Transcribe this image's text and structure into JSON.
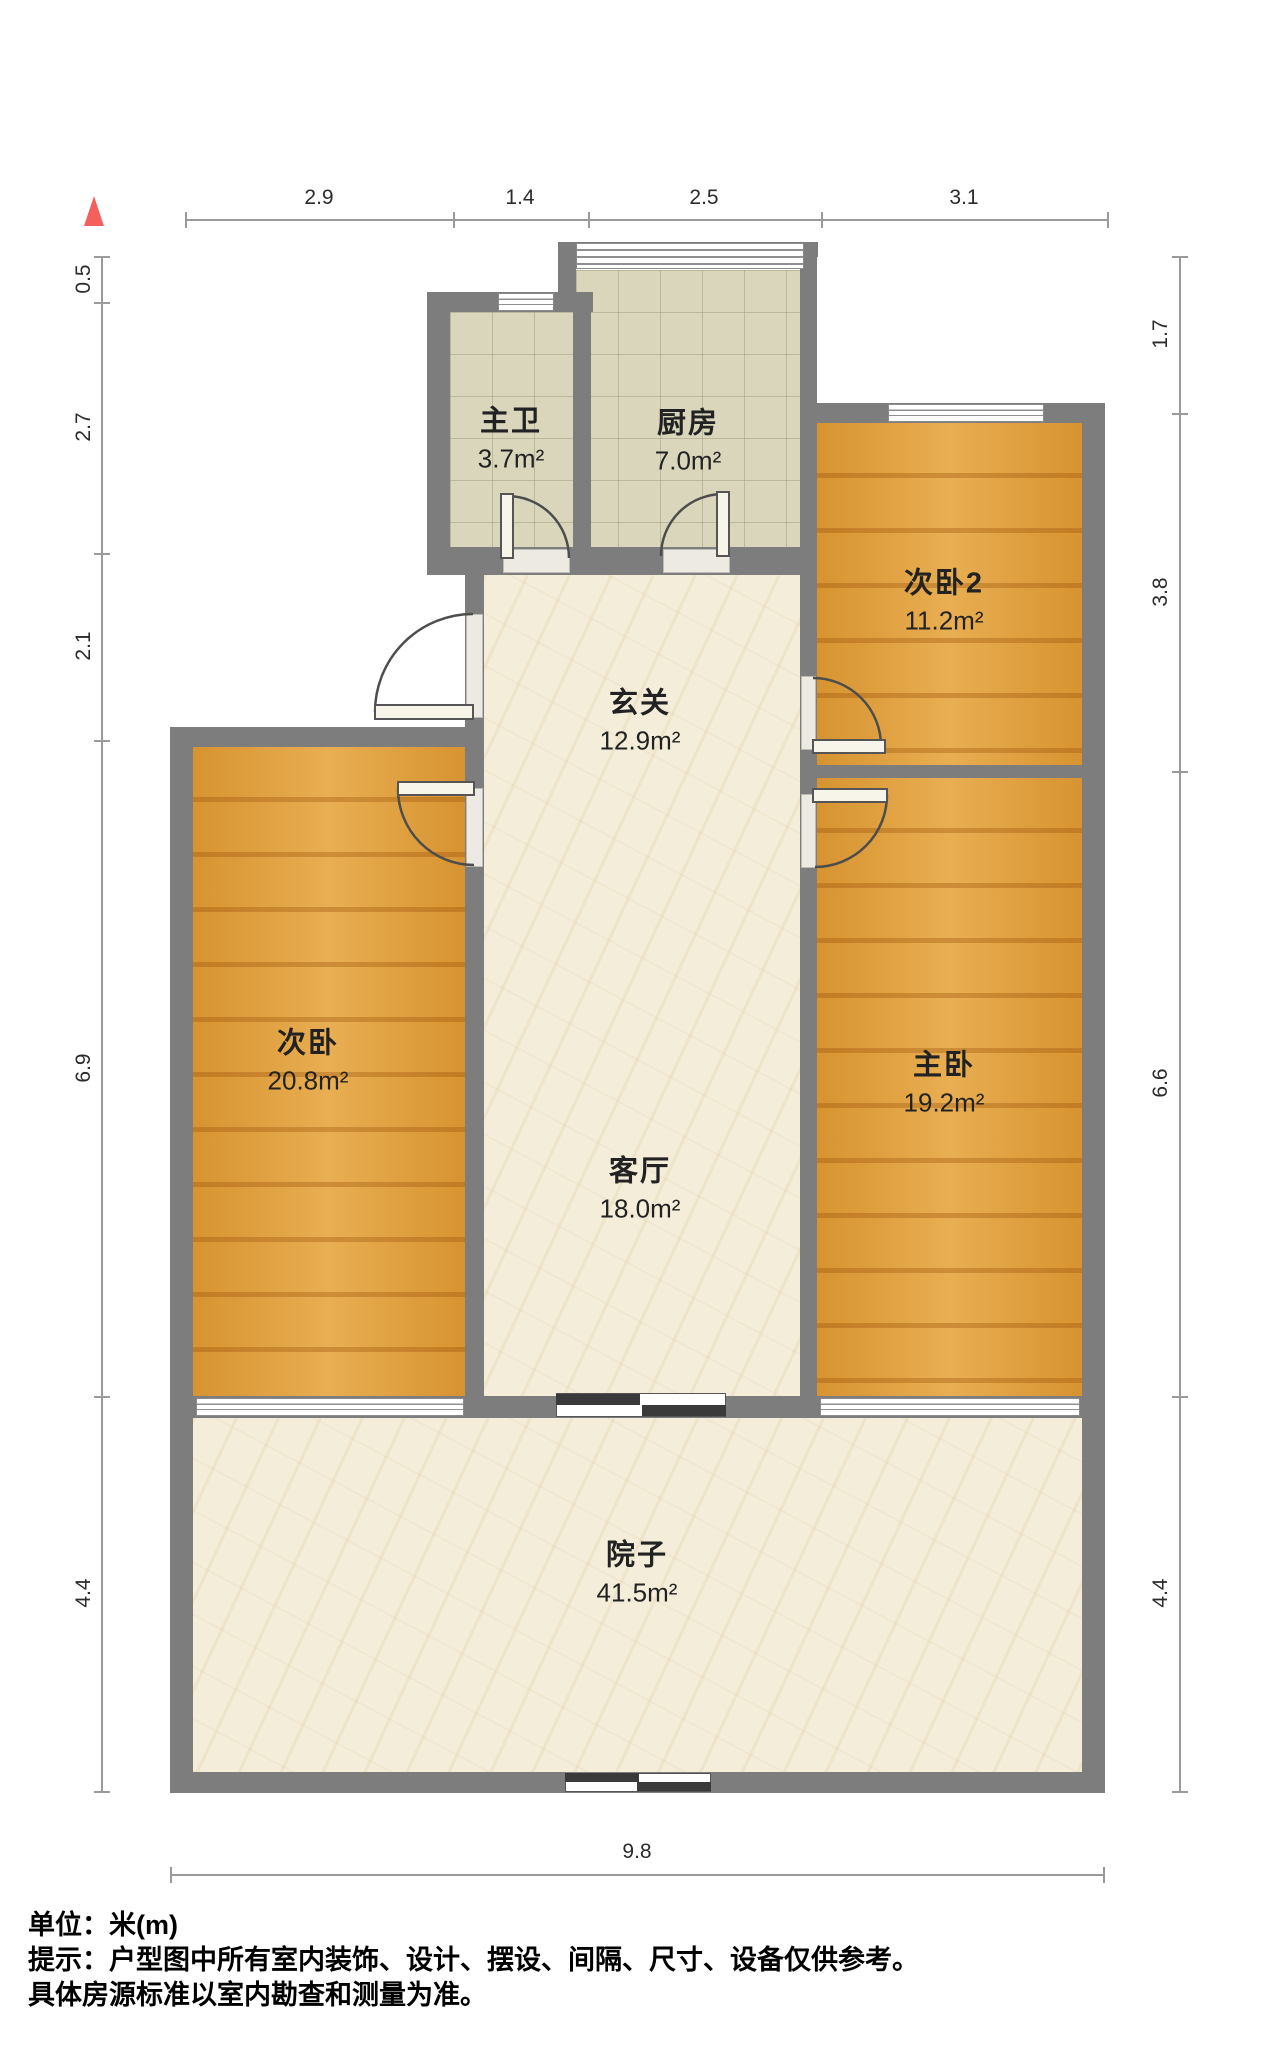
{
  "rooms": {
    "master_bath": {
      "name": "主卫",
      "area": "3.7m²"
    },
    "kitchen": {
      "name": "厨房",
      "area": "7.0m²"
    },
    "bedroom2": {
      "name": "次卧2",
      "area": "11.2m²"
    },
    "hallway": {
      "name": "玄关",
      "area": "12.9m²"
    },
    "bedroom": {
      "name": "次卧",
      "area": "20.8m²"
    },
    "master_bedroom": {
      "name": "主卧",
      "area": "19.2m²"
    },
    "living_room": {
      "name": "客厅",
      "area": "18.0m²"
    },
    "courtyard": {
      "name": "院子",
      "area": "41.5m²"
    }
  },
  "dimensions": {
    "top": [
      "2.9",
      "1.4",
      "2.5",
      "3.1"
    ],
    "left": [
      "0.5",
      "2.7",
      "2.1",
      "6.9",
      "4.4"
    ],
    "right": [
      "1.7",
      "3.8",
      "6.6",
      "4.4"
    ],
    "bottom": [
      "9.8"
    ]
  },
  "footer": {
    "unit_line": "单位：米(m)",
    "tip_line1": "提示：户型图中所有室内装饰、设计、摆设、间隔、尺寸、设备仅供参考。",
    "tip_line2": "具体房源标准以室内勘查和测量为准。"
  },
  "colors": {
    "wall": "#7d7d7d",
    "wood_floor": "#e29d36",
    "tile_floor": "#d9d6bc",
    "marble_floor": "#f4edda",
    "north_arrow": "#f4605c",
    "sliding_door": "#3a3a3a"
  }
}
